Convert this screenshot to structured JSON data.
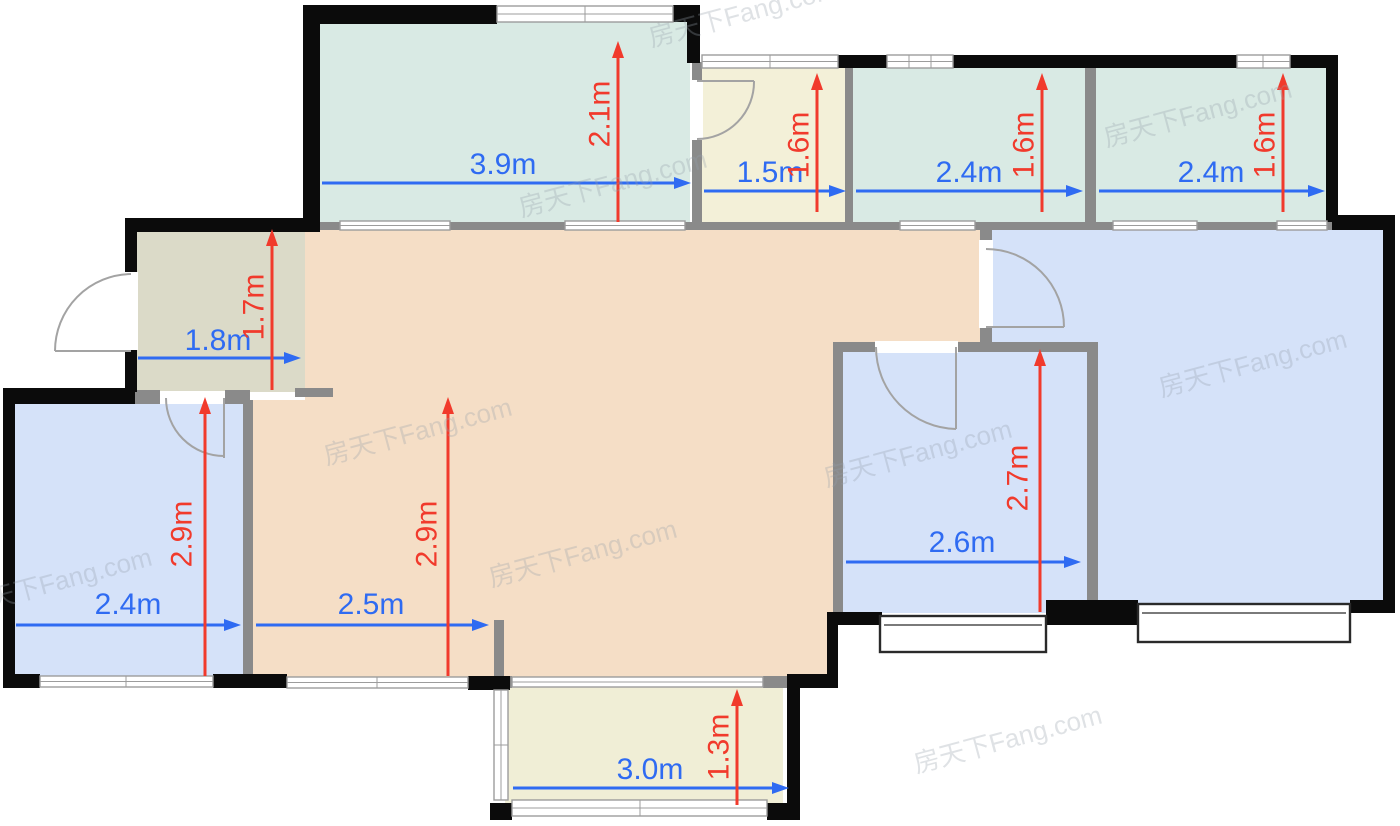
{
  "watermark": {
    "text": "房天下Fang.com"
  },
  "palette": {
    "wall": "#0b0b0b",
    "interior_wall": "#8a8a8a",
    "dim_blue": "#2f6bf2",
    "dim_red": "#f13a2c",
    "window_frame": "#9c9c9c",
    "room_teal": "#d9eae4",
    "room_cream": "#f3f0d8",
    "room_olive": "#dbdac8",
    "room_peach": "#f5dec6",
    "room_blue": "#d5e2f9",
    "balcony_cream": "#f0eed6"
  },
  "rooms": [
    {
      "name": "top-balcony",
      "width": "3.9m",
      "height": "2.1m"
    },
    {
      "name": "small-room",
      "width": "1.5m",
      "height": "1.6m"
    },
    {
      "name": "top-room-a",
      "width": "2.4m",
      "height": "1.6m"
    },
    {
      "name": "top-room-b",
      "width": "2.4m",
      "height": "1.6m"
    },
    {
      "name": "entry-hall",
      "width": "1.8m",
      "height": "1.7m"
    },
    {
      "name": "left-bedroom",
      "width": "2.4m",
      "height": "2.9m"
    },
    {
      "name": "dining-area",
      "width": "2.5m",
      "height": "2.9m"
    },
    {
      "name": "middle-bedroom",
      "width": "2.6m",
      "height": "2.7m"
    },
    {
      "name": "bottom-balcony",
      "width": "3.0m",
      "height": "1.3m"
    }
  ]
}
